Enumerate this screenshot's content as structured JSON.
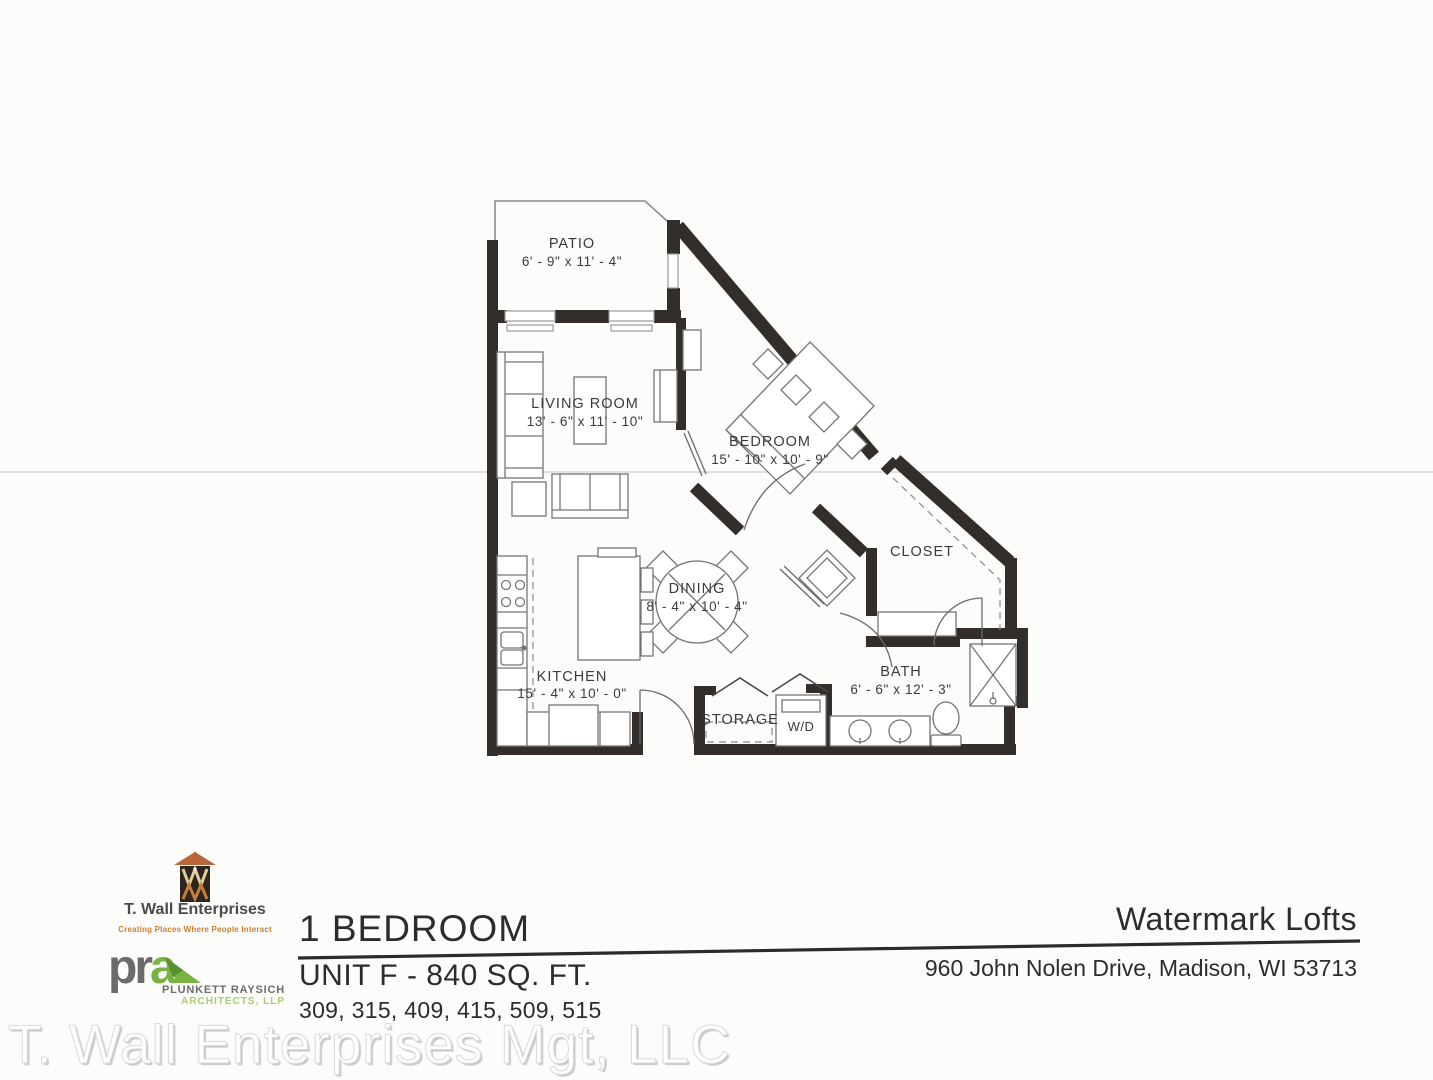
{
  "document": {
    "watermark": "T. Wall Enterprises Mgt, LLC"
  },
  "rooms": {
    "patio": {
      "label": "PATIO",
      "dims": "6' - 9\" x 11' - 4\""
    },
    "living_room": {
      "label": "LIVING ROOM",
      "dims": "13' - 6\" x 11' - 10\""
    },
    "bedroom": {
      "label": "BEDROOM",
      "dims": "15' - 10\" x 10' - 9\""
    },
    "dining": {
      "label": "DINING",
      "dims": "8' - 4\" x 10' - 4\""
    },
    "kitchen": {
      "label": "KITCHEN",
      "dims": "15' - 4\" x 10' - 0\""
    },
    "closet": {
      "label": "CLOSET"
    },
    "bath": {
      "label": "BATH",
      "dims": "6' - 6\" x 12' - 3\""
    },
    "storage": {
      "label": "STORAGE"
    },
    "washer_dryer": {
      "label": "W/D"
    }
  },
  "branding": {
    "developer": {
      "name": "T. Wall Enterprises",
      "tagline": "Creating Places Where People Interact"
    },
    "architect": {
      "abbr_gray": "pr",
      "abbr_green": "a",
      "firm": "PLUNKETT RAYSICH",
      "suffix": "ARCHITECTS, LLP"
    }
  },
  "unit": {
    "type": "1 BEDROOM",
    "spec": "UNIT F - 840 SQ. FT.",
    "unit_numbers": "309, 315, 409, 415, 509, 515"
  },
  "property": {
    "name": "Watermark Lofts",
    "address": "960 John Nolen Drive, Madison, WI 53713"
  },
  "colors": {
    "wall": "#332e2a",
    "accent_orange": "#cd7f2e",
    "accent_green": "#79b344",
    "text_dark": "#2c2c2c"
  }
}
